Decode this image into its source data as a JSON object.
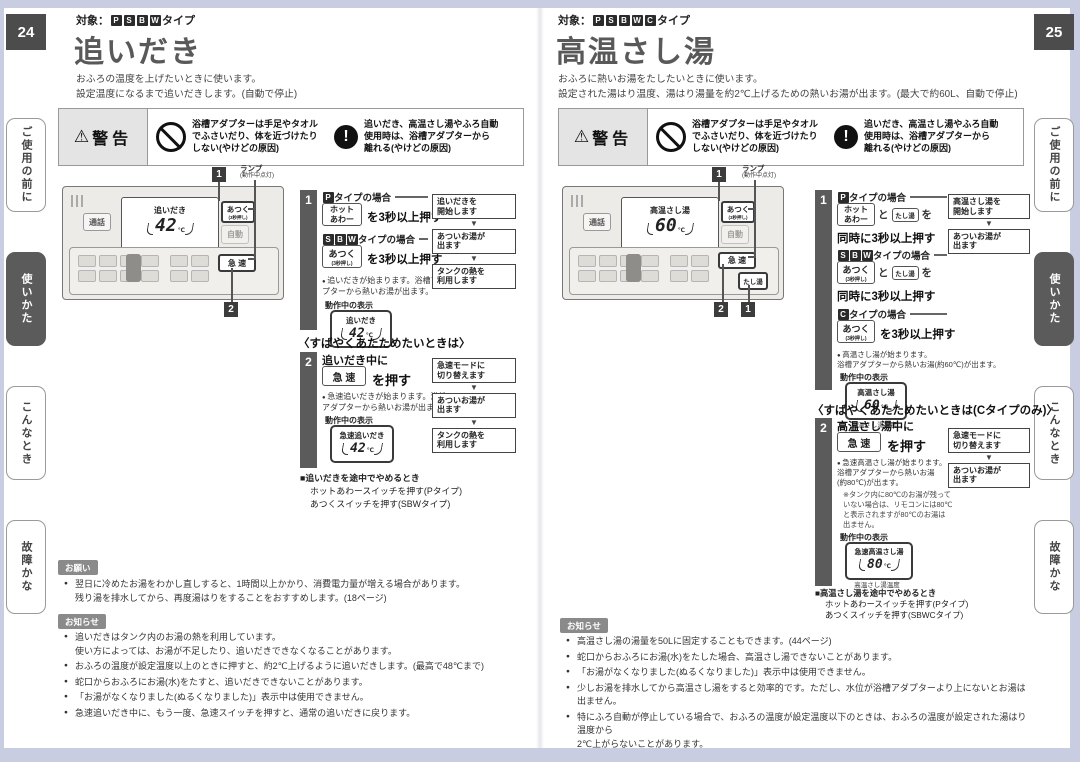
{
  "icons": {
    "warning_triangle": "⚠",
    "exclaim": "!",
    "down_arrow": "▼"
  },
  "tabs": [
    "ご使用の前に",
    "使いかた",
    "こんなとき",
    "故障かな"
  ],
  "p24": {
    "num": "24",
    "target_prefix": "対象：",
    "target_types": [
      "P",
      "S",
      "B",
      "W"
    ],
    "target_suffix": "タイプ",
    "title": "追いだき",
    "desc": "おふろの温度を上げたいときに使います。\n設定温度になるまで追いだきします。(自動で停止)",
    "warn": {
      "title": "警告",
      "no": "浴槽アダプターは手足やタオル\nでふさいだり、体を近づけたり\nしない(やけどの原因)",
      "ex": "追いだき、高温さし湯やふろ自動\n使用時は、浴槽アダプターから\n離れる(やけどの原因)"
    },
    "panel": {
      "c1": "1",
      "c2": "2",
      "lamp": "ランプ",
      "lamp_sub": "(動作中点灯)",
      "talk": "通話",
      "atsuku": "あつく",
      "atsuku_sub": "(3秒押し)",
      "auto": "自動",
      "rapid": "急 速",
      "disp_mode": "追いだき",
      "disp_temp": "42",
      "disp_unit": "℃"
    },
    "step1": {
      "n": "1",
      "case1_label": "タイプの場合",
      "case1_btn": "ホット\nあわー",
      "case1_after": "を3秒以上押す",
      "case2_label": "タイプの場合",
      "case2_btn": "あつく",
      "case2_btn_sub": "(3秒押し)",
      "case2_after": "を3秒以上押す",
      "bullet": "追いだきが始まります。浴槽アダ\nプターから熱いお湯が出ます。",
      "disp_label": "動作中の表示",
      "disp_mode": "追いだき",
      "disp_temp": "42",
      "disp_unit": "℃",
      "flow": [
        "追いだきを\n開始します",
        "あついお湯が\n出ます",
        "タンクの熱を\n利用します"
      ]
    },
    "quick_title": "〈すばやくあたためたいときは〉",
    "step2": {
      "n": "2",
      "lead": "追いだき中に",
      "btn": "急 速",
      "after": "を押す",
      "bullet": "急速追いだきが始まります。浴槽\nアダプターから熱いお湯が出ます。",
      "disp_label": "動作中の表示",
      "disp_mode": "急速追いだき",
      "disp_temp": "42",
      "disp_unit": "℃",
      "flow": [
        "急速モードに\n切り替えます",
        "あついお湯が\n出ます",
        "タンクの熱を\n利用します"
      ]
    },
    "stop": {
      "title": "■追いだきを途中でやめるとき",
      "l1": "ホットあわースイッチを押す(Pタイプ)",
      "l2": "あつくスイッチを押す(SBWタイプ)"
    },
    "onegai": {
      "label": "お願い",
      "items": [
        "翌日に冷めたお湯をわかし直しすると、1時間以上かかり、消費電力量が増える場合があります。\n残り湯を排水してから、再度湯はりをすることをおすすめします。(18ページ)"
      ]
    },
    "oshirase": {
      "label": "お知らせ",
      "items": [
        "追いだきはタンク内のお湯の熱を利用しています。\n使い方によっては、お湯が不足したり、追いだきできなくなることがあります。",
        "おふろの温度が設定温度以上のときに押すと、約2℃上げるように追いだきします。(最高で48℃まで)",
        "蛇口からおふろにお湯(水)をたすと、追いだきできないことがあります。",
        "「お湯がなくなりました(ぬるくなりました)」表示中は使用できません。",
        "急速追いだき中に、もう一度、急速スイッチを押すと、通常の追いだきに戻ります。"
      ]
    }
  },
  "p25": {
    "num": "25",
    "target_prefix": "対象：",
    "target_types": [
      "P",
      "S",
      "B",
      "W",
      "C"
    ],
    "target_suffix": "タイプ",
    "title": "高温さし湯",
    "desc": "おふろに熱いお湯をたしたいときに使います。\n設定された湯はり温度、湯はり湯量を約2℃上げるための熱いお湯が出ます。(最大で約60L、自動で停止)",
    "warn": {
      "title": "警告",
      "no": "浴槽アダプターは手足やタオル\nでふさいだり、体を近づけたり\nしない(やけどの原因)",
      "ex": "追いだき、高温さし湯やふろ自動\n使用時は、浴槽アダプターから\n離れる(やけどの原因)"
    },
    "panel": {
      "c1": "1",
      "c2": "2",
      "c3": "1",
      "lamp": "ランプ",
      "lamp_sub": "(動作中点灯)",
      "talk": "通話",
      "atsuku": "あつく",
      "atsuku_sub": "(3秒押し)",
      "auto": "自動",
      "rapid": "急 速",
      "tashiyu": "たし湯",
      "disp_mode": "高温さし湯",
      "disp_temp": "60",
      "disp_unit": "℃"
    },
    "step1": {
      "n": "1",
      "case1_label": "タイプの場合",
      "case1_btn": "ホット\nあわー",
      "joiner": "と",
      "tashiyu": "たし湯",
      "tail": "を",
      "hold": "同時に3秒以上押す",
      "case2_label": "タイプの場合",
      "case2_btn": "あつく",
      "case2_btn_sub": "(3秒押し)",
      "case3_label": "タイプの場合",
      "case3_btn": "あつく",
      "case3_btn_sub": "(3秒押し)",
      "case3_after": "を3秒以上押す",
      "bullet": "高温さし湯が始まります。\n浴槽アダプターから熱いお湯(約60℃)が出ます。",
      "disp_label": "動作中の表示",
      "disp_mode": "高温さし湯",
      "disp_temp": "60",
      "disp_unit": "℃",
      "disp_caption": "高温さし湯温度",
      "flow": [
        "高温さし湯を\n開始します",
        "あついお湯が\n出ます"
      ]
    },
    "quick_title": "〈すばやくあたためたいときは(Cタイプのみ)〉",
    "step2": {
      "n": "2",
      "lead": "高温さし湯中に",
      "btn": "急 速",
      "after": "を押す",
      "bullet": "急速高温さし湯が始まります。\n浴槽アダプターから熱いお湯\n(約80℃)が出ます。",
      "note": "※タンク内に80℃のお湯が残って\nいない場合は、リモコンには80℃\nと表示されますが80℃のお湯は\n出ません。",
      "disp_label": "動作中の表示",
      "disp_mode": "急速高温さし湯",
      "disp_temp": "80",
      "disp_unit": "℃",
      "disp_caption": "高温さし湯温度",
      "flow": [
        "急速モードに\n切り替えます",
        "あついお湯が\n出ます"
      ]
    },
    "stop": {
      "title": "■高温さし湯を途中でやめるとき",
      "l1": "ホットあわースイッチを押す(Pタイプ)",
      "l2": "あつくスイッチを押す(SBWCタイプ)"
    },
    "oshirase": {
      "label": "お知らせ",
      "items": [
        "高温さし湯の湯量を50Lに固定することもできます。(44ページ)",
        "蛇口からおふろにお湯(水)をたした場合、高温さし湯できないことがあります。",
        "「お湯がなくなりました(ぬるくなりました)」表示中は使用できません。",
        "少しお湯を排水してから高温さし湯をすると効率的です。ただし、水位が浴槽アダプターより上にないとお湯は出ません。",
        "特にふろ自動が停止している場合で、おふろの温度が設定温度以下のときは、おふろの温度が設定された湯はり温度から\n2℃上がらないことがあります。"
      ]
    }
  }
}
